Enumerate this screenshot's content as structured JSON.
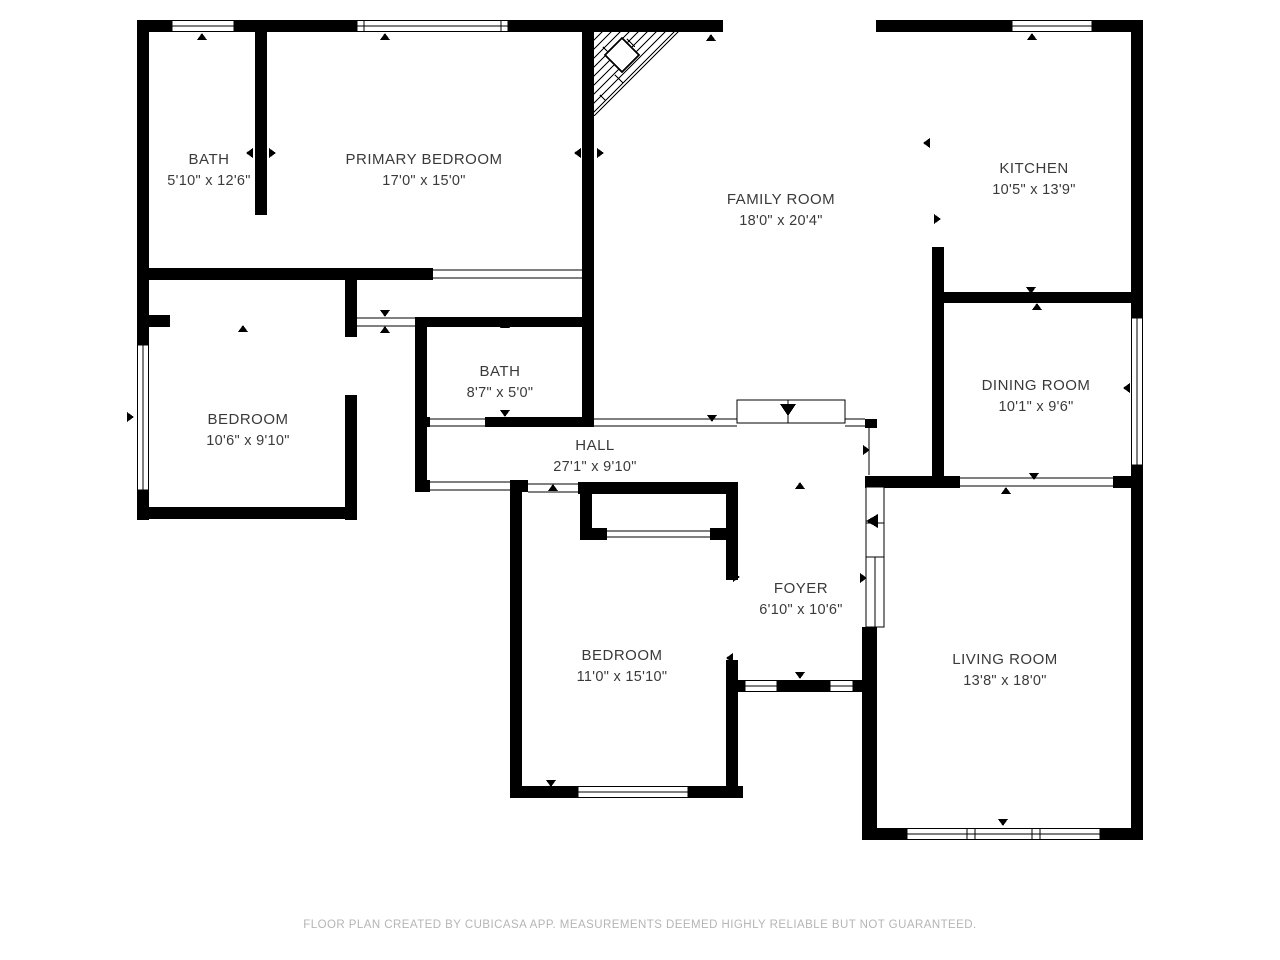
{
  "colors": {
    "wall": "#000000",
    "label_text": "#3a3a3a",
    "footer_text": "#b5b5b5",
    "background": "#ffffff"
  },
  "rooms": [
    {
      "id": "bath-upper",
      "name": "BATH",
      "dims": "5'10\" x 12'6\""
    },
    {
      "id": "primary-bedroom",
      "name": "PRIMARY BEDROOM",
      "dims": "17'0\" x 15'0\""
    },
    {
      "id": "family-room",
      "name": "FAMILY ROOM",
      "dims": "18'0\" x 20'4\""
    },
    {
      "id": "kitchen",
      "name": "KITCHEN",
      "dims": "10'5\" x 13'9\""
    },
    {
      "id": "bedroom-left",
      "name": "BEDROOM",
      "dims": "10'6\" x 9'10\""
    },
    {
      "id": "bath-center",
      "name": "BATH",
      "dims": "8'7\" x 5'0\""
    },
    {
      "id": "hall",
      "name": "HALL",
      "dims": "27'1\" x 9'10\""
    },
    {
      "id": "dining-room",
      "name": "DINING ROOM",
      "dims": "10'1\" x 9'6\""
    },
    {
      "id": "foyer",
      "name": "FOYER",
      "dims": "6'10\" x 10'6\""
    },
    {
      "id": "bedroom-lower",
      "name": "BEDROOM",
      "dims": "11'0\" x 15'10\""
    },
    {
      "id": "living-room",
      "name": "LIVING ROOM",
      "dims": "13'8\" x 18'0\""
    }
  ],
  "footer": {
    "text": "FLOOR PLAN CREATED BY CUBICASA APP. MEASUREMENTS DEEMED HIGHLY RELIABLE BUT NOT GUARANTEED."
  }
}
